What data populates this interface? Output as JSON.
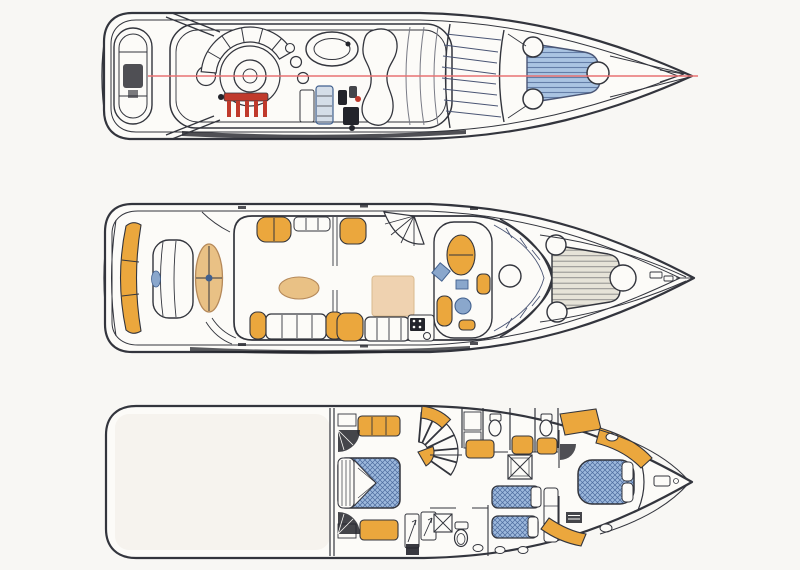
{
  "figure": {
    "kind": "yacht-deck-plans-drawing",
    "views": [
      {
        "id": "flybridge",
        "name": "flybridge deck plan",
        "features": [
          "stern-tender",
          "radar-arch",
          "circular-dinette",
          "backrest-cushion-fan",
          "barbecue-grill",
          "bar-stools",
          "side-table",
          "wet-bar-cabinet",
          "drinks-cooler",
          "oval-spa-lounger",
          "chaise-sunbed",
          "coachroof-seams",
          "windshield-mullions",
          "bow-sunpad",
          "deck-hatches",
          "centerline-datum"
        ]
      },
      {
        "id": "main-deck",
        "name": "main deck plan",
        "features": [
          "transom-settee",
          "engine-hatch-bench",
          "sun-lounger-oval",
          "cockpit-corner-sofa",
          "cockpit-sofa",
          "cockpit-table",
          "saloon-corner-settees",
          "saloon-sofa",
          "saloon-rug",
          "galley-stove",
          "stairs-to-flybridge",
          "dinette-helm-room",
          "helm-seat",
          "chart-table",
          "stool",
          "windshield",
          "foredeck-sunpad",
          "deck-hatches",
          "anchor-windlass"
        ]
      },
      {
        "id": "lower-deck",
        "name": "lower deck plan",
        "features": [
          "engine-room",
          "bulkhead",
          "midship-double-bed",
          "dressers",
          "door-swings",
          "spiral-staircase",
          "wardrobe-lockers",
          "shower-boxes",
          "toilets",
          "washbasins",
          "twin-berths",
          "berth-dresser",
          "vip-double-bed",
          "vip-wardrobe",
          "vip-seat",
          "bow-stowage-hatch"
        ]
      }
    ]
  },
  "colors": {
    "page_bg": "#f8f7f4",
    "paper": "#fcfbf8",
    "line": "#33353d",
    "line_soft": "#787a85",
    "cushion_orange": "#eba73d",
    "table_tan": "#e9c185",
    "tan_line": "#b5895a",
    "rug_tan": "#efd2b0",
    "rug_line": "#d9b98e",
    "pad_blue": "#aac4e2",
    "pad_blue_line": "#647ea8",
    "pad_gray": "#e6e3d8",
    "pad_gray_line": "#90908e",
    "bed_blue": "#9db9dd",
    "bed_blue_line": "#4e6c9e",
    "accent_blue": "#8aa7cc",
    "accent_blue_deep": "#41608e",
    "grill_red": "#c03a2c",
    "centerline_red": "#e87272",
    "dark_fill": "#23242b",
    "window_line": "#4a5574",
    "engine_room": "#f1efe8"
  }
}
